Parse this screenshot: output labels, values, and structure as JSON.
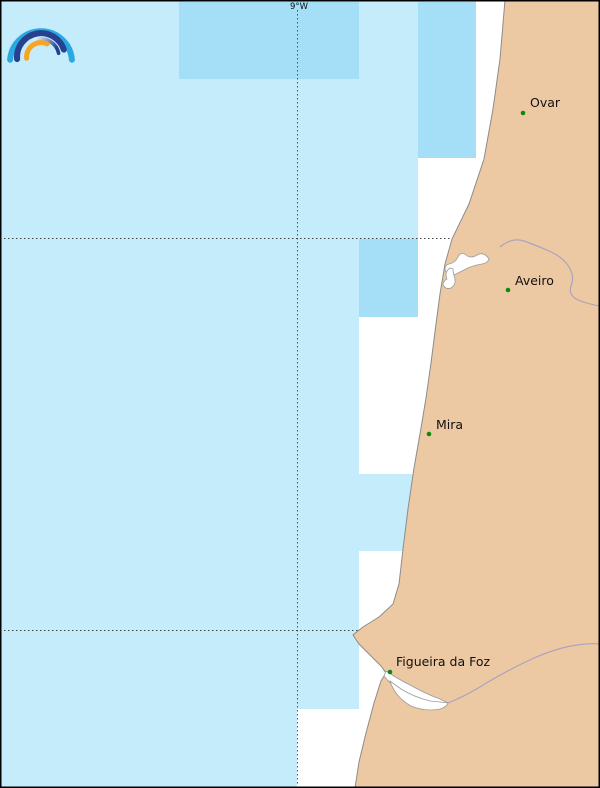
{
  "map": {
    "meridian_label": "9°W",
    "cities": [
      {
        "name": "Ovar"
      },
      {
        "name": "Aveiro"
      },
      {
        "name": "Mira"
      },
      {
        "name": "Figueira da Foz"
      }
    ],
    "colors": {
      "ocean": "#c4ecfb",
      "highlight_cell": "#a4def7",
      "land": "#edc9a3",
      "gap": "#ffffff",
      "coastline": "#8c8c8c",
      "river": "#aba3bf",
      "water_feature": "#ffffff",
      "water_feature_edge": "#9a9a9a",
      "city_marker": "#0c8a0c",
      "label": "#111111",
      "graticule": "#444444",
      "frame": "#000000"
    }
  },
  "logo": {
    "name": "rainbow-arcs-logo",
    "colors": {
      "outer_arc": "#2aa9e1",
      "middle_arc": "#27408f",
      "inner_arc": "#27408f",
      "inner_fade": "#d9edf9",
      "accent_arc": "#f7a623"
    }
  }
}
